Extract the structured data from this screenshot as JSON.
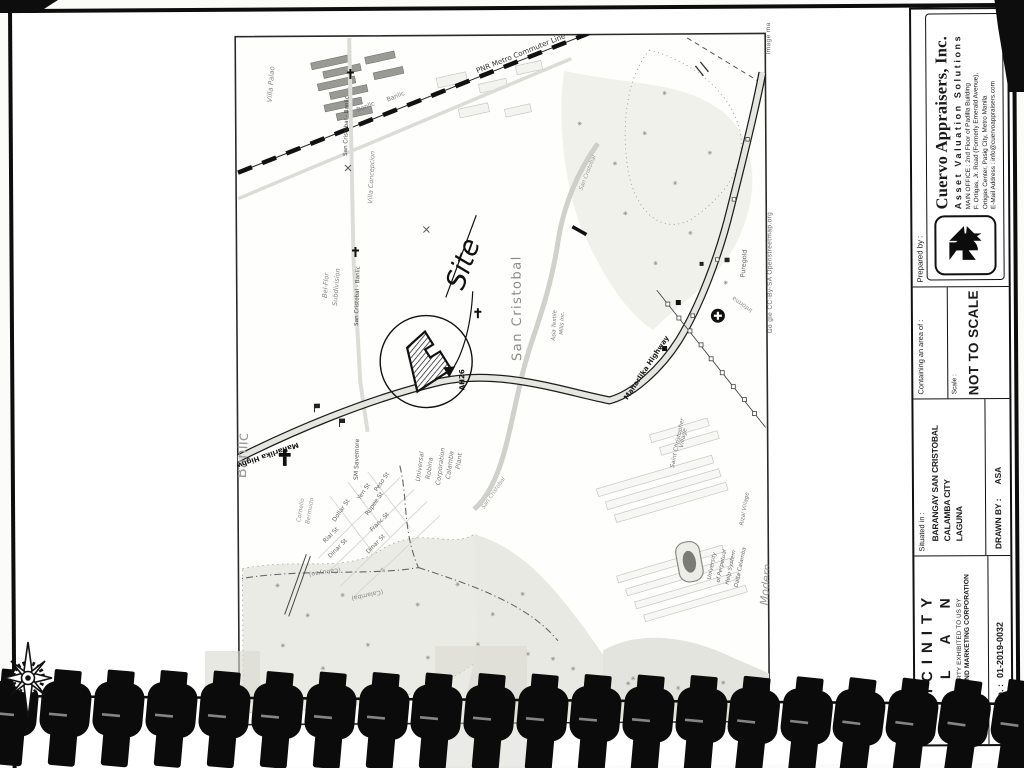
{
  "map": {
    "labels": {
      "villa_palao": "Villa Palao",
      "pnr_line": "PNR Metro Commuter Line",
      "banlic_road_1": "Banlic",
      "banlic_road_2": "Banlic",
      "san_cristobal_banlic_1": "San Cristobal - Banlic",
      "san_cristobal_banlic_2": "San Cristobal - Banlic",
      "villa_concepcion": "Villa Concepcion",
      "bel_flor_1": "Bel-Flor",
      "bel_flor_2": "Subdivision",
      "banlic_area": "Banlic",
      "site": "Site",
      "san_cristobal_area": "San Cristobal",
      "asia_textile_1": "Asia Textile",
      "asia_textile_2": "Mills Inc.",
      "ah26": "AH26",
      "maharlika_1": "Maharlika Highway",
      "maharlika_2": "Maharlika Highway",
      "sm_savemore": "SM Savemore",
      "urc": [
        "Universal",
        "Robina",
        "Corporation",
        "Calamba",
        "Plant"
      ],
      "cornelio_1": "Cornelio",
      "cornelio_2": "Bermudo",
      "streets": [
        "Dollar St",
        "Yen St",
        "Rupee St",
        "Peso St",
        "Franc St",
        "Rial St",
        "Dinar St",
        "Dinar St"
      ],
      "boundary_cabuyao": "(Cabuyao)",
      "boundary_calamba": "(Calamba)",
      "creek_1": "San Cristobal",
      "creek_2": "San Cristobal",
      "saint_christopher_1": "Saint Christopher",
      "saint_christopher_2": "Village",
      "informa": "Informa",
      "puregold": "Puregold",
      "university": [
        "University",
        "of Perpetual",
        "Help System",
        "Dalta Calamba"
      ],
      "rizal_village": "Rizal Village",
      "modern": "Modern",
      "prifood_1": "Prifood",
      "prifood_2": "rporation",
      "attribution": "Go gle  CC-By-SA Openstreetmap.org",
      "image_note": "Image ma"
    }
  },
  "titleblock": {
    "prepared_by_label": "Prepared by :",
    "company": "Cuervo Appraisers, Inc.",
    "tagline": "Asset Valuation Solutions",
    "address_1": "MAIN OFFICE : 2nd Floor of Padilla Building",
    "address_2": "F. Ortigas, Jr. Road (Formerly Emerald Avenue),",
    "address_3": "Ortigas Center, Pasig City, Metro Manila",
    "address_4": "E-Mail Address : info@cuervoappraisers.com",
    "containing_label": "Containing an area of :",
    "scale_label": "Scale :",
    "scale_value": "NOT TO SCALE",
    "situated_label": "Situated in :",
    "situated_1": "BARANGAY SAN CRISTOBAL",
    "situated_2": "CALAMBA CITY",
    "situated_3": "LAGUNA",
    "drawn_by_label": "DRAWN BY :",
    "drawn_by_value": "ASA",
    "title_line_1": "VICINITY",
    "title_line_2": "PLAN",
    "property_note_1": "PROPERTY EXHIBITED TO US BY",
    "property_note_2": "TH TIMBERLAND MARKETING CORPORATION",
    "file_no_label": "CAI File No. :",
    "file_no_value": "01-2019-0032"
  }
}
